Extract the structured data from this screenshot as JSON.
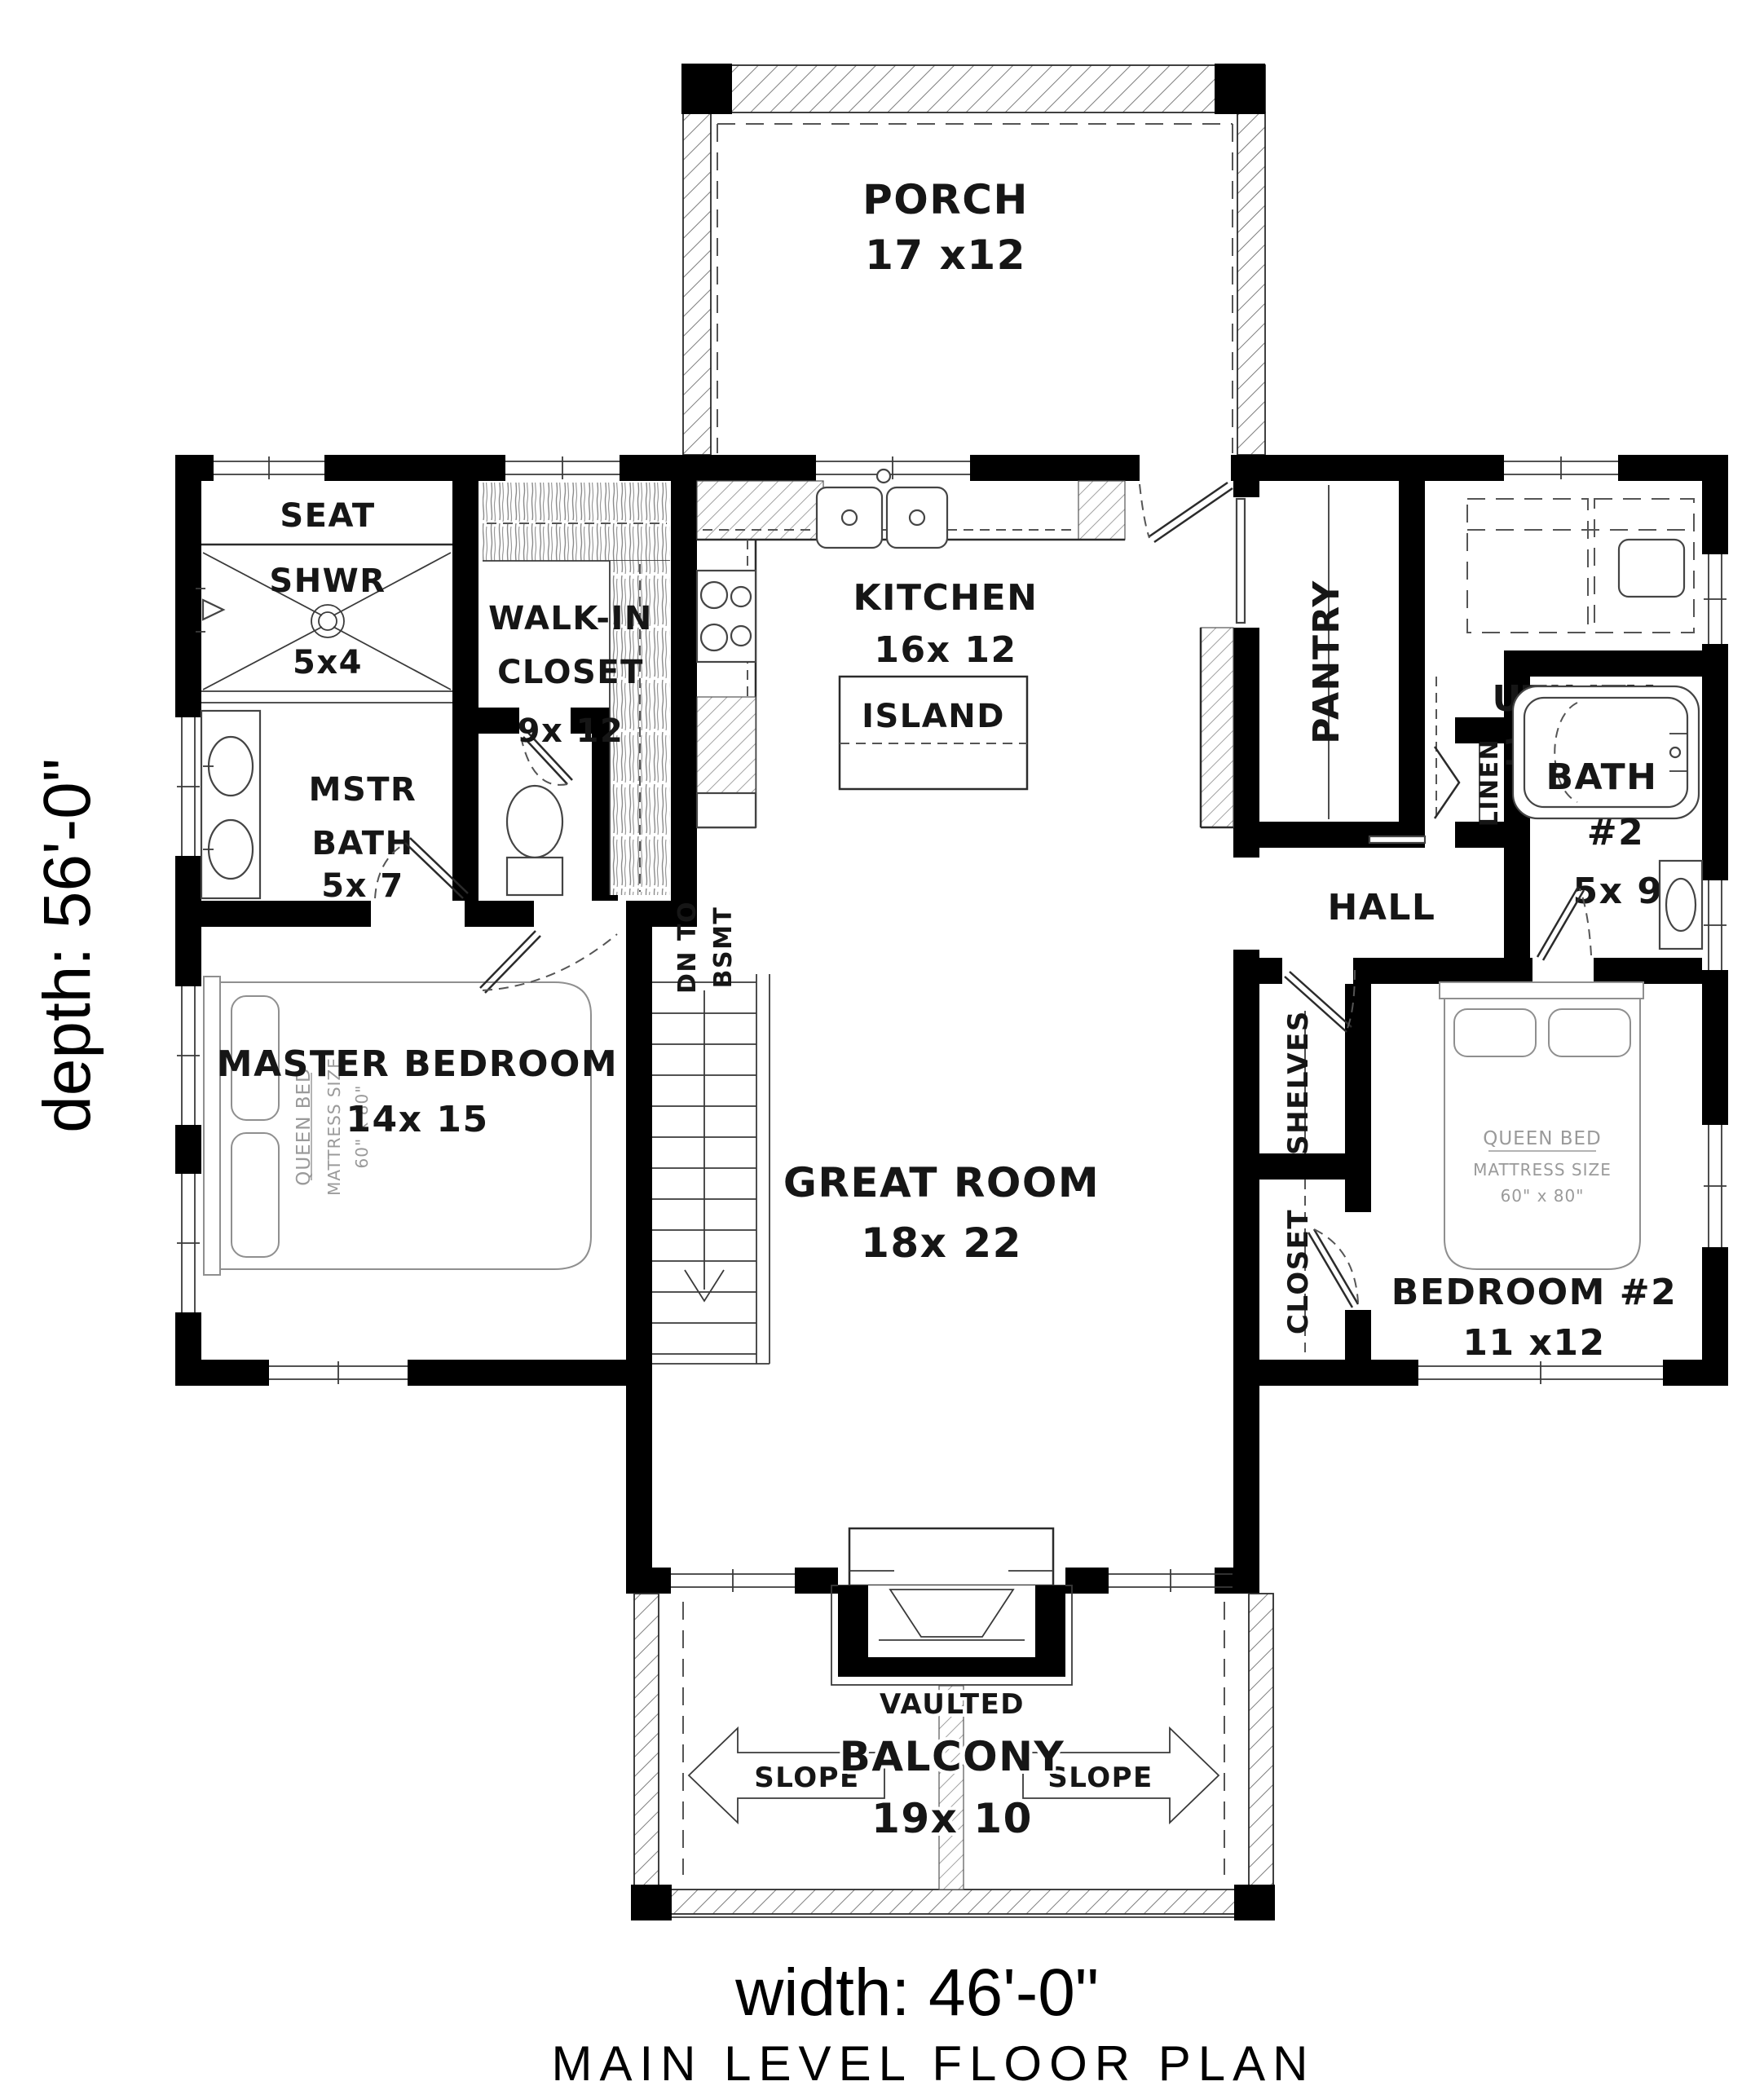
{
  "title": "MAIN LEVEL FLOOR PLAN",
  "dimensions": {
    "width": "width: 46'-0\"",
    "depth": "depth: 56'-0\""
  },
  "rooms": {
    "porch": {
      "name": "PORCH",
      "size": "17 x12"
    },
    "kitchen": {
      "name": "KITCHEN",
      "size": "16x 12"
    },
    "island": {
      "name": "ISLAND"
    },
    "pantry": {
      "name": "PANTRY"
    },
    "utility": {
      "name": "UTILITY",
      "size": "11x 11"
    },
    "shower": {
      "name1": "SEAT",
      "name2": "SHWR",
      "size": "5x4"
    },
    "walk_in_closet": {
      "name1": "WALK-IN",
      "name2": "CLOSET",
      "size": "9x 12"
    },
    "master_bath": {
      "name1": "MSTR",
      "name2": "BATH",
      "size": "5x 7"
    },
    "bath2": {
      "name1": "BATH",
      "name2": "#2",
      "size": "5x 9"
    },
    "linen": {
      "name": "LINEN"
    },
    "hall": {
      "name": "HALL"
    },
    "master_bedroom": {
      "name": "MASTER BEDROOM",
      "size": "14x 15"
    },
    "great_room": {
      "name": "GREAT ROOM",
      "size": "18x 22"
    },
    "shelves": {
      "name": "SHELVES"
    },
    "closet": {
      "name": "CLOSET"
    },
    "bedroom2": {
      "name": "BEDROOM #2",
      "size": "11 x12"
    },
    "balcony": {
      "modifier": "VAULTED",
      "name": "BALCONY",
      "size": "19x 10"
    },
    "stairs": {
      "line1": "DN TO",
      "line2": "BSMT"
    },
    "slope": {
      "left": "SLOPE",
      "right": "SLOPE"
    },
    "bed_master": {
      "line1": "QUEEN BED",
      "line2": "MATTRESS SIZE",
      "line3": "60\" x 80\""
    },
    "bed2": {
      "line1": "QUEEN BED",
      "line2": "MATTRESS SIZE",
      "line3": "60\" x 80\""
    }
  }
}
